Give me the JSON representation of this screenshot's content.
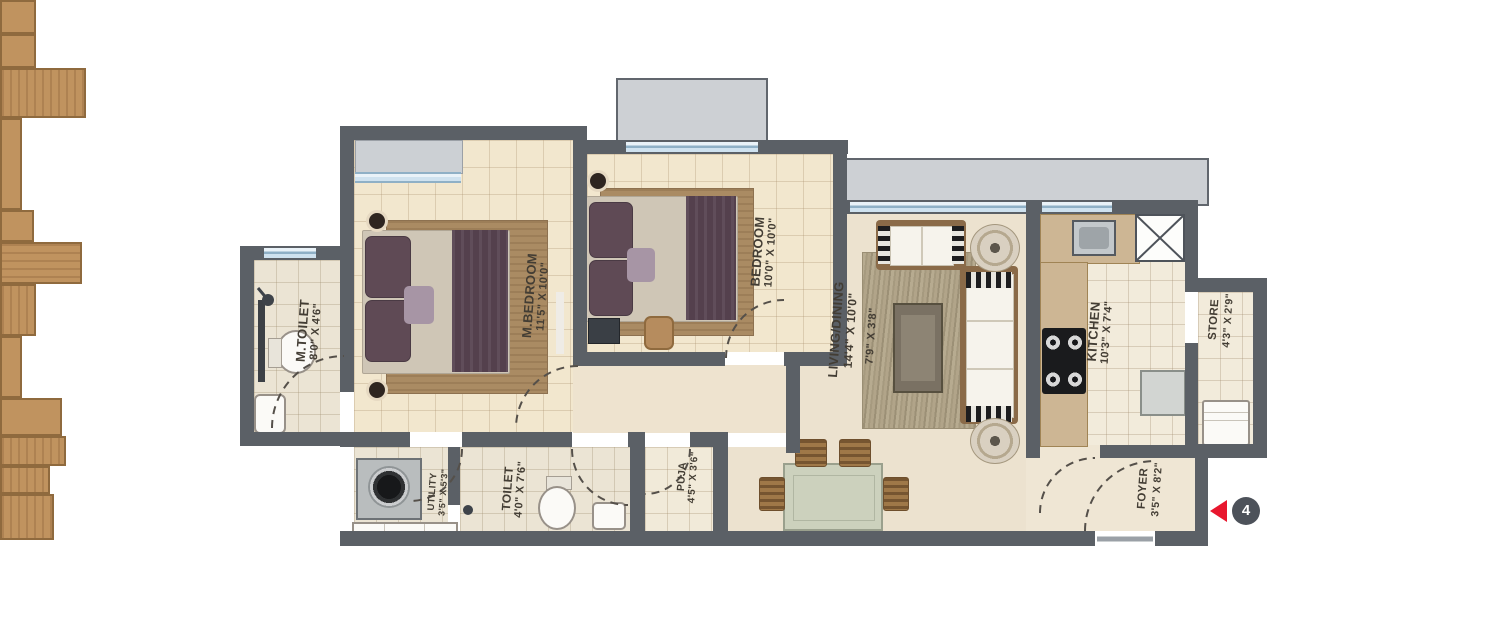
{
  "plan": {
    "type": "apartment-floor-plan",
    "rooms": [
      {
        "id": "m_toilet",
        "name": "M.TOILET",
        "dim": "8'0\" X 4'6\""
      },
      {
        "id": "m_bedroom",
        "name": "M.BEDROOM",
        "dim": "11'5\" X 10'0\""
      },
      {
        "id": "bedroom",
        "name": "BEDROOM",
        "dim": "10'0\" X 10'0\""
      },
      {
        "id": "living_dining",
        "name": "LIVING/DINING",
        "dim": "14'4\" X 10'0\""
      },
      {
        "id": "deck",
        "name": "",
        "dim": "7'9\" X 3'8\""
      },
      {
        "id": "kitchen",
        "name": "KITCHEN",
        "dim": "10'3\" X 7'4\""
      },
      {
        "id": "store",
        "name": "STORE",
        "dim": "4'3\" X 2'9\""
      },
      {
        "id": "utility",
        "name": "UTILITY",
        "dim": "3'5\" X 5'3\""
      },
      {
        "id": "toilet",
        "name": "TOILET",
        "dim": "4'0\" X 7'6\""
      },
      {
        "id": "puja",
        "name": "PUJA",
        "dim": "4'5\" X 3'6\""
      },
      {
        "id": "foyer",
        "name": "FOYER",
        "dim": "3'5\" X 8'2\""
      }
    ],
    "marker": {
      "number": "4"
    },
    "colors": {
      "wall": "#5b6066",
      "floor_beige": "#f2e7ce",
      "deck_gray": "#cdd0d4",
      "window_blue": "#cfe2ef",
      "wood": "#c0935f",
      "bed_purple": "#5f4a55",
      "marker_red": "#e8172e",
      "badge_gray": "#4d525a"
    }
  }
}
